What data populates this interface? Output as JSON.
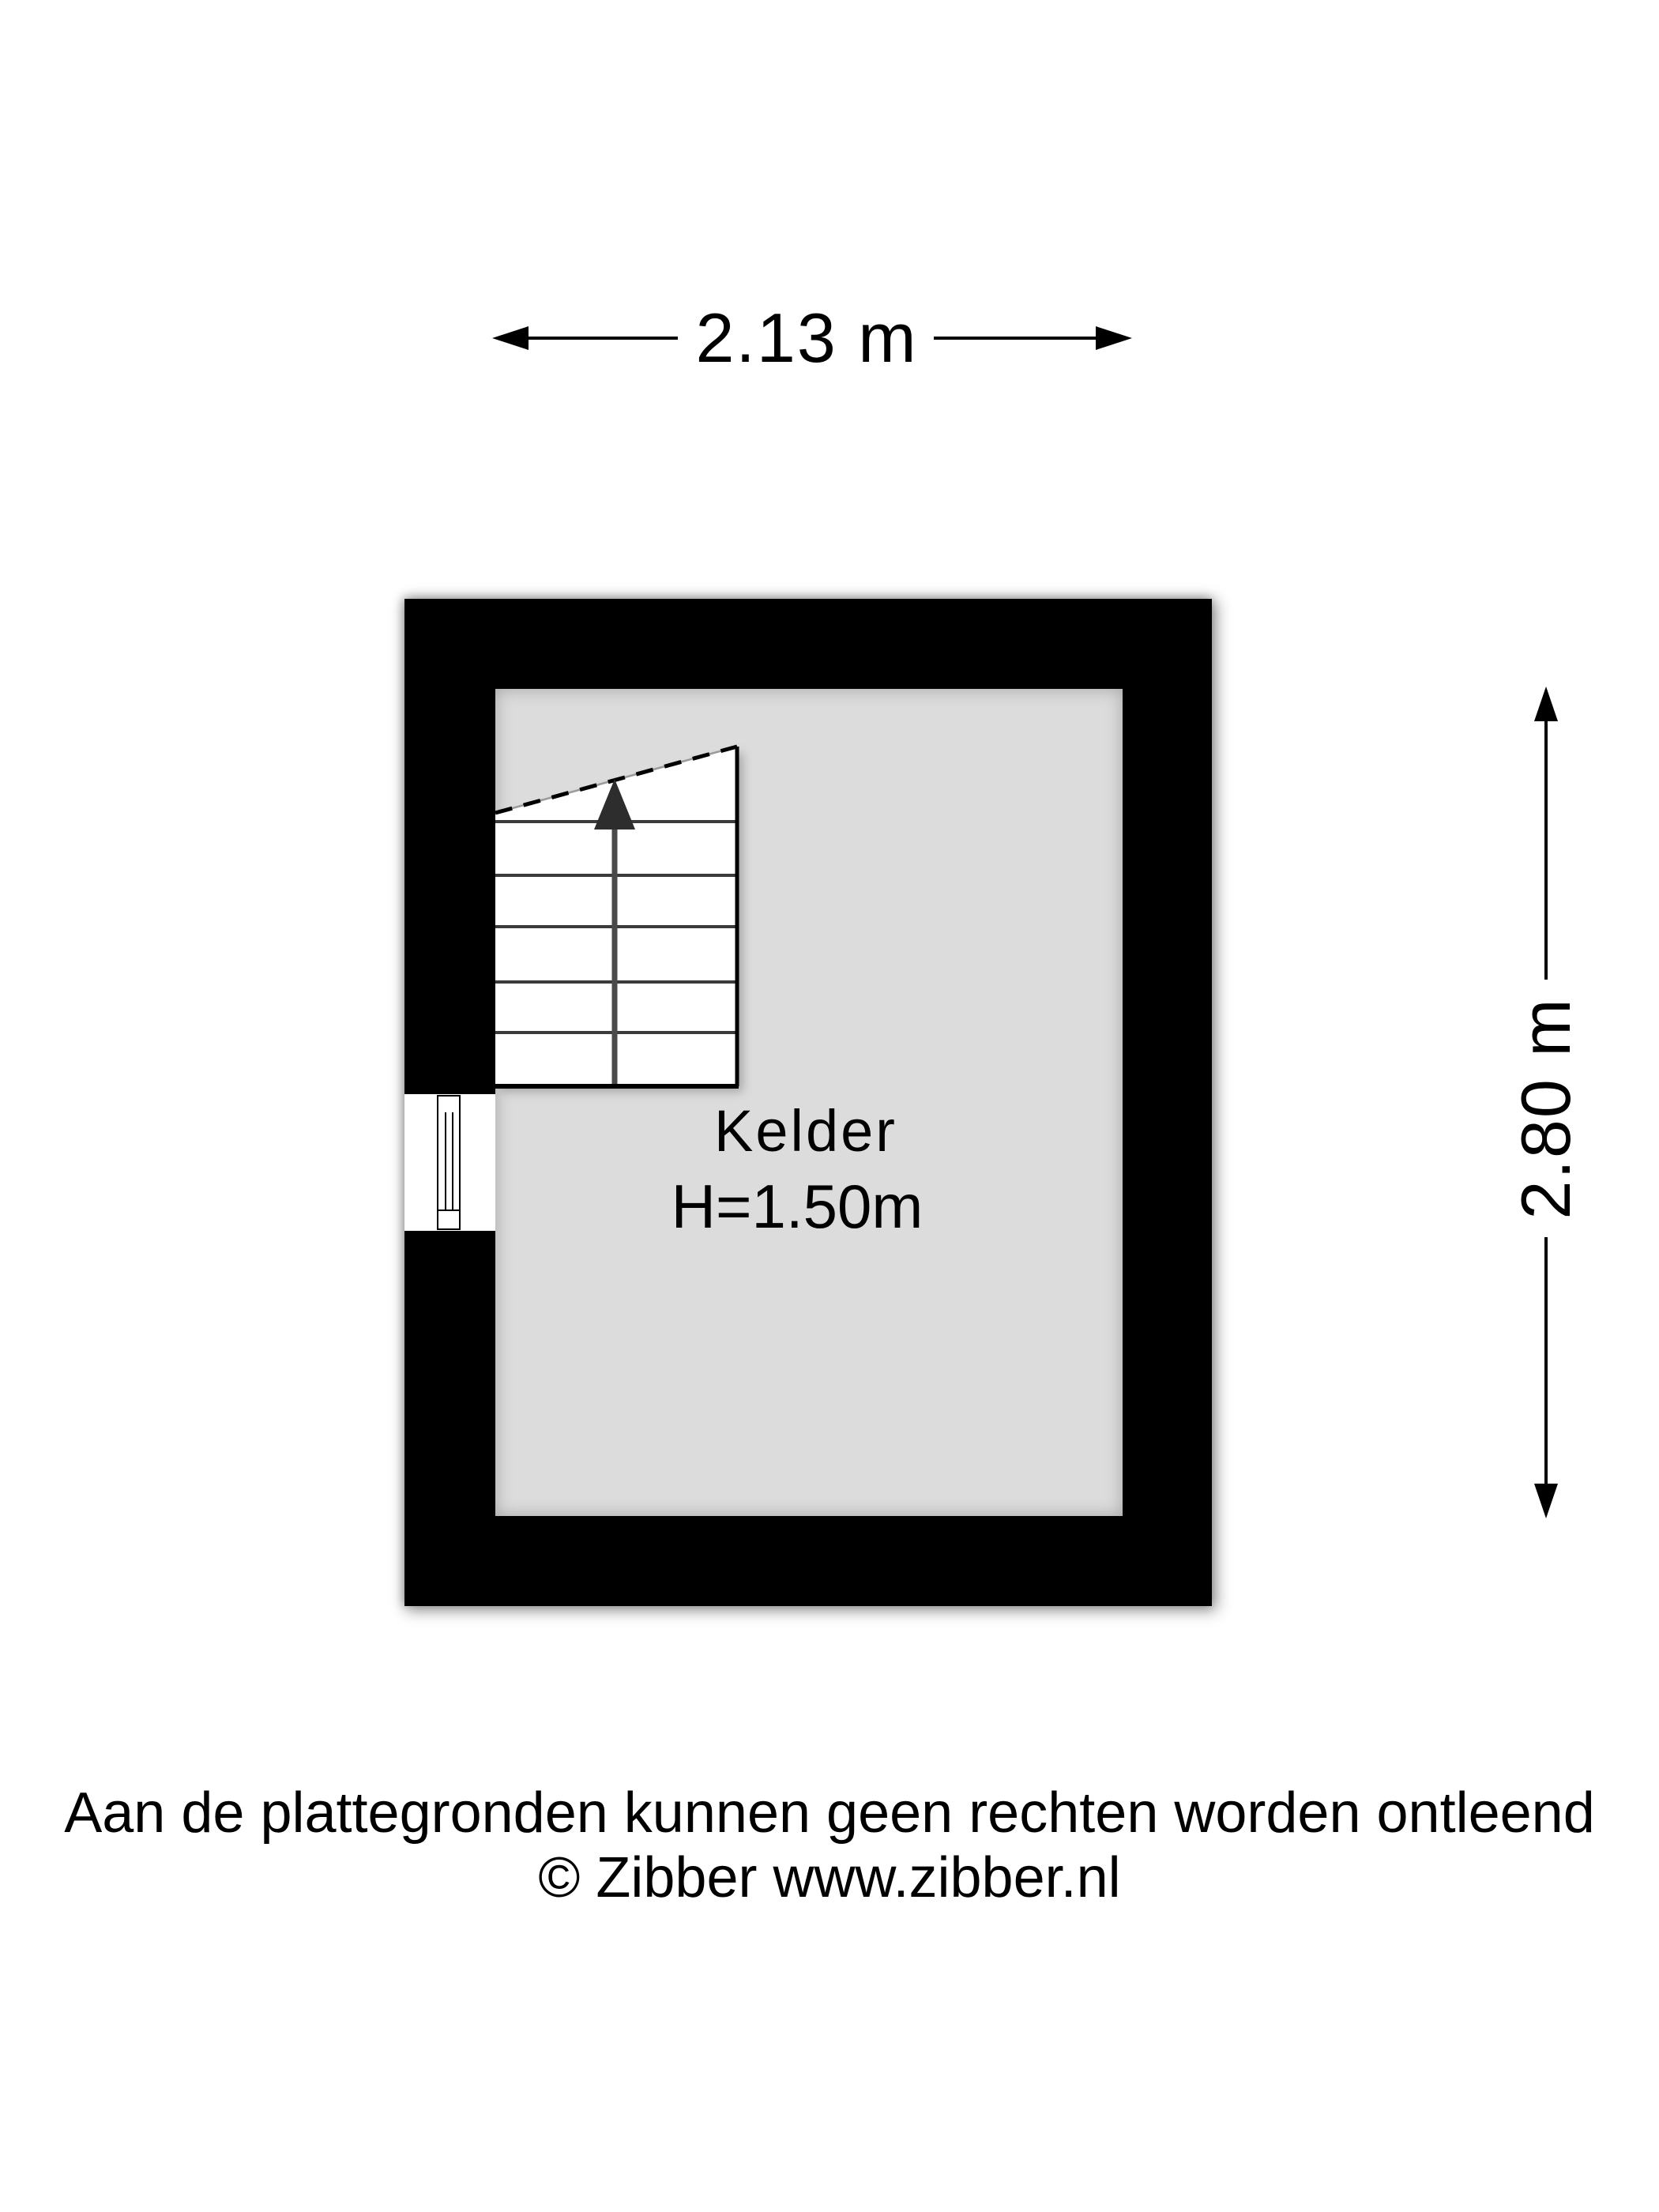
{
  "page": {
    "background": "#ffffff",
    "type_note": "basement floor plan"
  },
  "dimensions": {
    "width": {
      "label": "2.13 m"
    },
    "height": {
      "label": "2.80 m"
    }
  },
  "room": {
    "name": "Kelder",
    "height_note": "H=1.50m"
  },
  "footer": {
    "disclaimer": "Aan de plattegronden kunnen geen rechten worden ontleend",
    "copyright": "© Zibber www.zibber.nl"
  },
  "colors": {
    "wall": "#000000",
    "floor": "#dcdcdc",
    "stair_fill": "#ffffff",
    "line": "#000000",
    "stair_arrow": "#2d2d2d",
    "text": "#000000"
  }
}
